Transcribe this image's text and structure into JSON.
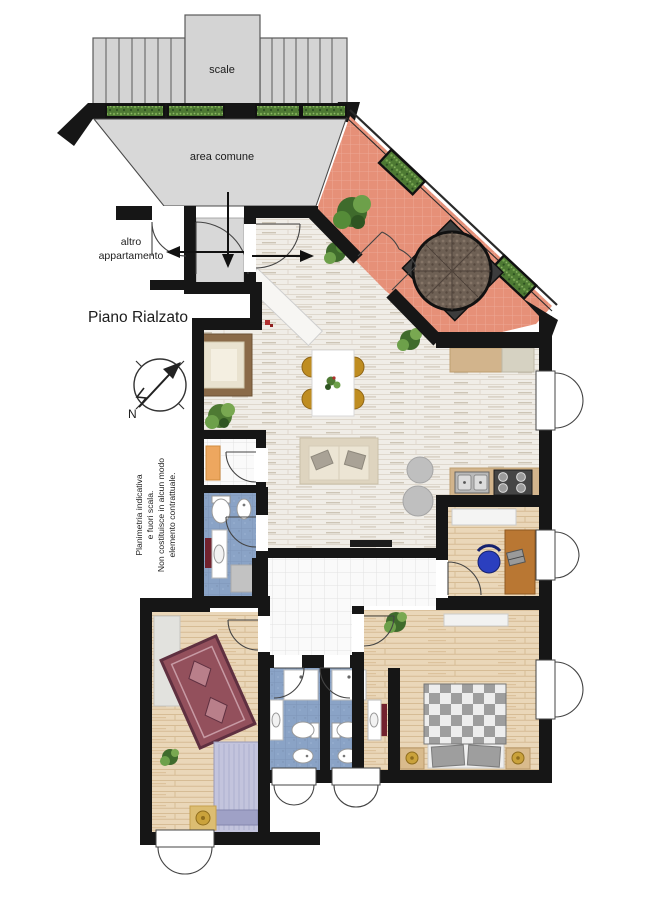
{
  "labels": {
    "scale": "scale",
    "area_comune": "area comune",
    "altro_1": "altro",
    "altro_2": "appartamento",
    "piano": "Piano Rialzato",
    "compass_n": "N",
    "disclaimer": [
      "Planimetria indicativa",
      "e fuori scala.",
      "Non costituisce in alcun modo",
      "elemento contrattuale."
    ]
  },
  "colors": {
    "wall": "#161616",
    "common_gray": "#d8d8d8",
    "stairs_gray": "#d4d4d4",
    "terrace_tile": "#e69078",
    "bath_blue": "#8aa3c6",
    "plank_living": "#f0ede7",
    "wood_bedroom": "#ead7b9",
    "accent_gold": "#bf8d21",
    "rug_red": "#93505c",
    "bed_lavender": "#c3c4dd"
  }
}
